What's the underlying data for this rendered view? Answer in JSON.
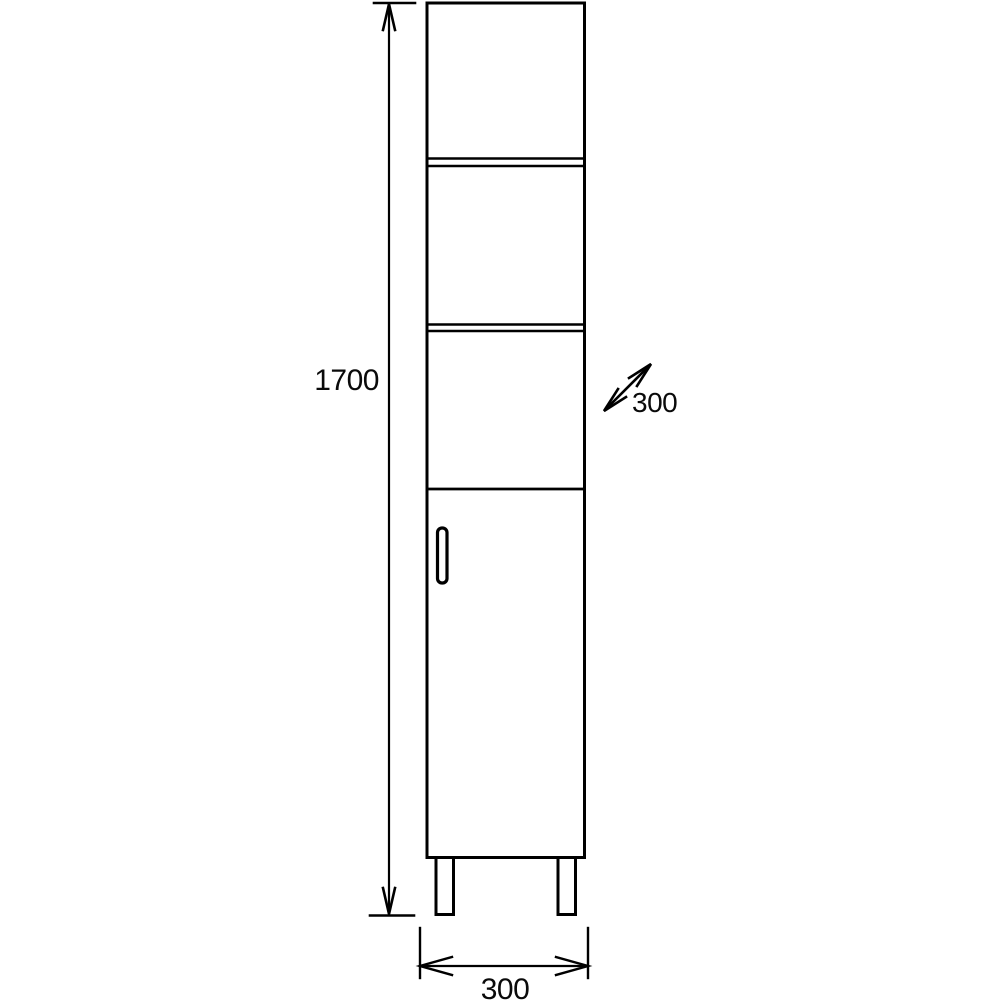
{
  "drawing": {
    "subject": "tall-cabinet-front-elevation",
    "labels": {
      "height": "1700",
      "depth": "300",
      "width": "300"
    },
    "colors": {
      "line": "#000000",
      "background": "#ffffff"
    }
  }
}
